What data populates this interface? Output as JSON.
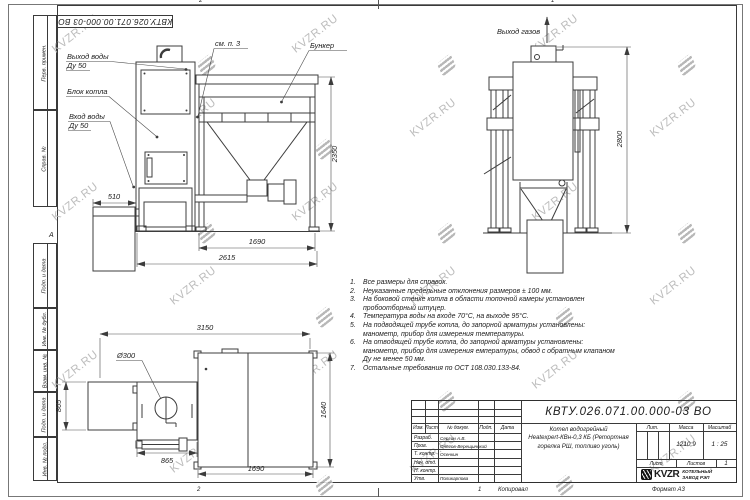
{
  "watermark": {
    "text": "KVZR.RU"
  },
  "sheet": {
    "doc_number": "КВТУ.026.071.00.000-03 ВО",
    "copied_label": "Копировал",
    "format_label": "Формат А3",
    "zone_top_left": "2",
    "zone_top_right": "1",
    "zone_bottom_left": "2",
    "zone_bottom_right": "1",
    "zone_letter": "А"
  },
  "margin_stamps": {
    "cells": [
      "Перв. примен.",
      "Справ. №",
      "Подп. и дата",
      "Инв. № дубл.",
      "Взам. инв. №",
      "Подп. и дата",
      "Инв. № подл."
    ]
  },
  "views": {
    "front": {
      "label_outlet_1": "Выход воды",
      "label_outlet_2": "Ду 50",
      "label_block": "Блок котла",
      "label_inlet_1": "Вход воды",
      "label_inlet_2": "Ду 50",
      "label_see": "см. п. 3",
      "label_bunker": "Бункер",
      "dim_height": "2350",
      "dim_ashbox": "510",
      "dim_bunker": "1690",
      "dim_total": "2615"
    },
    "side": {
      "label_gas": "Выход газов",
      "dim_height": "2800"
    },
    "plan": {
      "dim_total": "3150",
      "dim_flue": "Ø300",
      "dim_left": "865",
      "dim_boiler": "865",
      "dim_bunker": "1690",
      "dim_depth": "1640"
    }
  },
  "notes": [
    {
      "num": "1.",
      "text": "Все размеры для справок."
    },
    {
      "num": "2.",
      "text": "Неуказанные предельные отклонения размеров ± 100 мм."
    },
    {
      "num": "3.",
      "text": "На боковой стенке котла в области топочной камеры установлен пробоотборный штуцер."
    },
    {
      "num": "4.",
      "text": "Температура воды на входе 70°С, на выходе 95°С."
    },
    {
      "num": "5.",
      "text": "На подводящей трубе котла, до запорной арматуры установлены: манометр, прибор для измерения температуры."
    },
    {
      "num": "6.",
      "text": "На отводящей трубе котла, до запорной арматуры установлены: манометр, прибор для измерения емпературы, обвод с обратным клапаном Ду не менее 50 мм."
    },
    {
      "num": "7.",
      "text": "Остальные требования по ОСТ 108.030.133-84."
    }
  ],
  "title_block": {
    "doc_number": "КВТУ.026.071.00.000-03 ВО",
    "product_lines": [
      "Котел водогрейный",
      "Heatexpert-КВн-0,3 КБ (Ретортная",
      "горелка РШ, топливо уголь)"
    ],
    "headers": {
      "izm": "Изм.",
      "list": "Лист",
      "doc": "№ докум.",
      "sign": "Подп.",
      "date": "Дата",
      "lit": "Лит.",
      "mass": "Масса",
      "scale": "Масштаб",
      "sheet": "Лист",
      "sheets": "Листов"
    },
    "rows": [
      {
        "role": "Разраб.",
        "name": "Сергин А.В."
      },
      {
        "role": "Пров.",
        "name": "Онегов-Верещинский"
      },
      {
        "role": "Т. контр.",
        "name": "Осенкин"
      },
      {
        "role": "Нач. отд.",
        "name": ""
      },
      {
        "role": "Н. контр.",
        "name": ""
      },
      {
        "role": "Утв.",
        "name": "Поликарпова"
      }
    ],
    "mass_value": "1210,9",
    "scale_value": "1 : 25",
    "sheets_value": "1",
    "company": {
      "logo_text": "KVZR",
      "name_line1": "КОТЕЛЬНЫЙ",
      "name_line2": "ЗАВОД РЭП"
    }
  }
}
